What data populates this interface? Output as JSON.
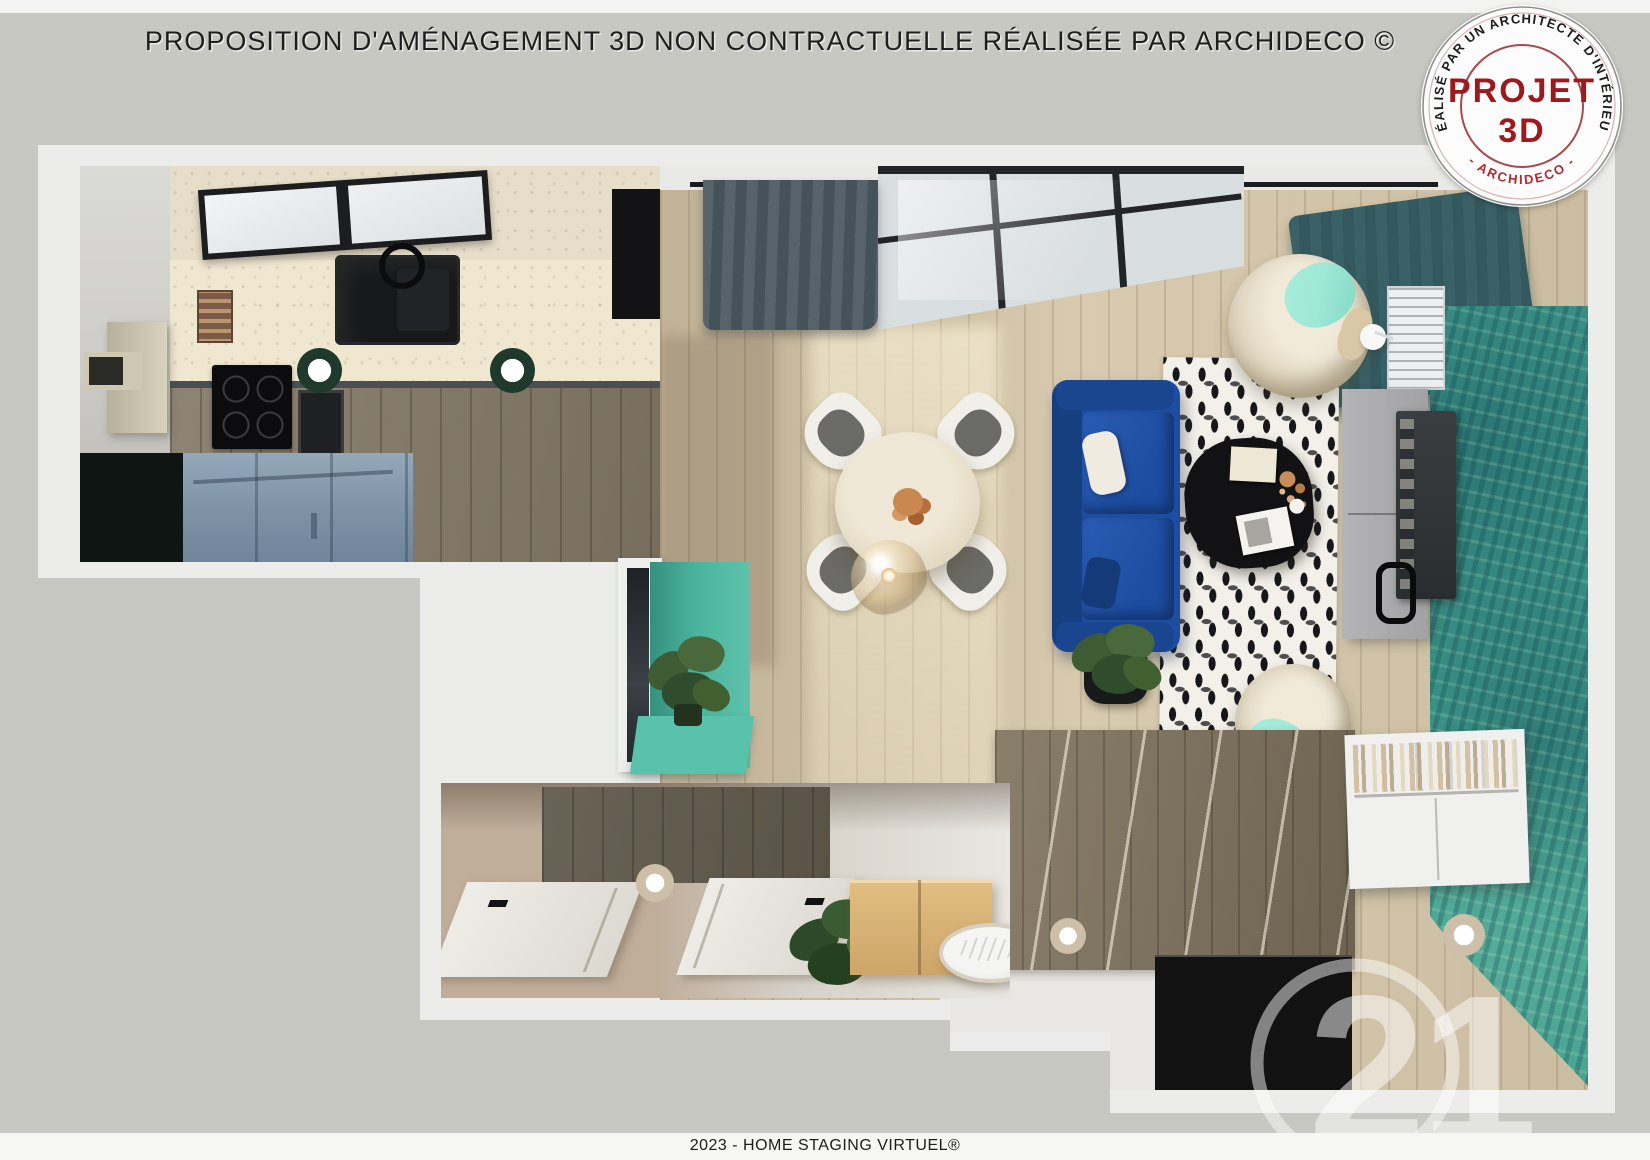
{
  "header": {
    "title": "PROPOSITION D'AMÉNAGEMENT 3D NON CONTRACTUELLE RÉALISÉE PAR ARCHIDECO ©"
  },
  "stamp": {
    "arc_top": "RÉALISÉ PAR UN ARCHITECTE D'INTÉRIEUR",
    "arc_bottom": "- ARCHIDECO -",
    "line1": "PROJET",
    "line2": "3D"
  },
  "footer": {
    "caption": "2023 - HOME STAGING VIRTUEL®"
  },
  "watermark": {
    "text": "21"
  },
  "colors": {
    "bg": "#c6c8c1",
    "card": "#ececea",
    "stamp_red": "#9c1a1e",
    "sofa_blue": "#1c4da1",
    "teal": "#3f9c8b",
    "mint": "#9fe7d6",
    "wood_light": "#cdbfa4",
    "wood_dark": "#7c7260",
    "hall_beige": "#c0ae9b",
    "cabinet_blue": "#8094a7",
    "curtain_slate": "#46525a",
    "curtain_teal": "#33595e"
  }
}
